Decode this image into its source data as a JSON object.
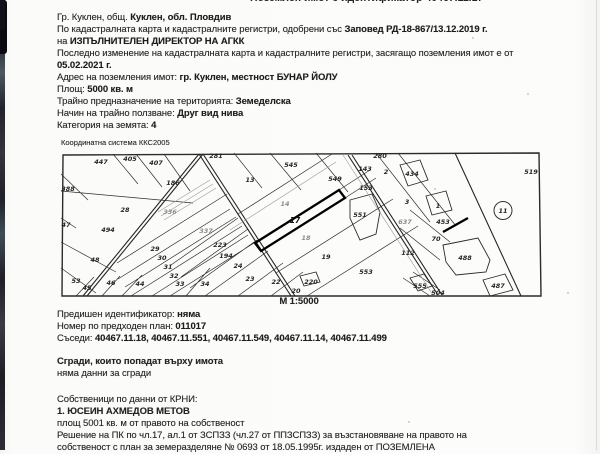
{
  "header": {
    "clipped_line": "Поземлен имот с идентификатор 40467.11.17"
  },
  "intro": {
    "lines": [
      {
        "pre": "Гр. Куклен, общ. ",
        "bold": "Куклен, обл. Пловдив"
      },
      {
        "pre": "По кадастралната карта и кадастралните регистри, одобрени със ",
        "bold": "Заповед РД-18-867/13.12.2019 г."
      },
      {
        "pre": "на ",
        "bold": "ИЗПЪЛНИТЕЛЕН ДИРЕКТОР НА АГКК"
      },
      {
        "pre": "Последно изменение на кадастралната карта и кадастралните регистри, засягащо поземления имот е от",
        "bold": ""
      },
      {
        "pre": "",
        "bold": "05.02.2021 г."
      },
      {
        "pre": "Адрес на поземления имот: ",
        "bold": "гр. Куклен, местност БУНАР ЙОЛУ"
      },
      {
        "pre": "Площ: ",
        "bold": "5000 кв. м"
      },
      {
        "pre": "Трайно предназначение на територията: ",
        "bold": "Земеделска"
      },
      {
        "pre": "Начин на трайно ползване: ",
        "bold": "Друг вид нива"
      },
      {
        "pre": "Категория на земята: ",
        "bold": "4"
      }
    ]
  },
  "map": {
    "coordinate_system": "Координатна система ККС2005",
    "scale": "М 1:5000",
    "subject_parcel": "17",
    "labels": [
      {
        "t": "447",
        "x": 43,
        "y": 14
      },
      {
        "t": "405",
        "x": 72,
        "y": 11
      },
      {
        "t": "407",
        "x": 98,
        "y": 15
      },
      {
        "t": "281",
        "x": 158,
        "y": 8
      },
      {
        "t": "545",
        "x": 233,
        "y": 17
      },
      {
        "t": "186",
        "x": 115,
        "y": 35
      },
      {
        "t": "13",
        "x": 192,
        "y": 32
      },
      {
        "t": "549",
        "x": 277,
        "y": 31
      },
      {
        "t": "280",
        "x": 322,
        "y": 8
      },
      {
        "t": "2",
        "x": 328,
        "y": 24
      },
      {
        "t": "434",
        "x": 354,
        "y": 26
      },
      {
        "t": "143",
        "x": 307,
        "y": 21
      },
      {
        "t": "153",
        "x": 308,
        "y": 40
      },
      {
        "t": "3",
        "x": 349,
        "y": 54
      },
      {
        "t": "1",
        "x": 380,
        "y": 58
      },
      {
        "t": "519",
        "x": 473,
        "y": 24
      },
      {
        "t": "11",
        "x": 445,
        "y": 63,
        "circled": true
      },
      {
        "t": "388",
        "x": 10,
        "y": 41
      },
      {
        "t": "28",
        "x": 67,
        "y": 62
      },
      {
        "t": "47",
        "x": 8,
        "y": 77
      },
      {
        "t": "494",
        "x": 50,
        "y": 82
      },
      {
        "t": "48",
        "x": 37,
        "y": 112
      },
      {
        "t": "53",
        "x": 18,
        "y": 133
      },
      {
        "t": "45",
        "x": 29,
        "y": 140
      },
      {
        "t": "46",
        "x": 53,
        "y": 135
      },
      {
        "t": "44",
        "x": 82,
        "y": 136
      },
      {
        "t": "29",
        "x": 97,
        "y": 101
      },
      {
        "t": "30",
        "x": 104,
        "y": 110
      },
      {
        "t": "31",
        "x": 110,
        "y": 119
      },
      {
        "t": "32",
        "x": 116,
        "y": 128
      },
      {
        "t": "33",
        "x": 122,
        "y": 136
      },
      {
        "t": "34",
        "x": 147,
        "y": 136
      },
      {
        "t": "337",
        "x": 148,
        "y": 83,
        "grey": true
      },
      {
        "t": "223",
        "x": 162,
        "y": 97
      },
      {
        "t": "194",
        "x": 168,
        "y": 108
      },
      {
        "t": "24",
        "x": 180,
        "y": 118
      },
      {
        "t": "23",
        "x": 192,
        "y": 131
      },
      {
        "t": "22",
        "x": 218,
        "y": 134
      },
      {
        "t": "20",
        "x": 238,
        "y": 143
      },
      {
        "t": "14",
        "x": 227,
        "y": 56,
        "grey": true
      },
      {
        "t": "17",
        "x": 237,
        "y": 73,
        "bold": true
      },
      {
        "t": "18",
        "x": 248,
        "y": 90,
        "grey": true
      },
      {
        "t": "19",
        "x": 268,
        "y": 109
      },
      {
        "t": "551",
        "x": 302,
        "y": 67
      },
      {
        "t": "336",
        "x": 112,
        "y": 64,
        "grey": true
      },
      {
        "t": "637",
        "x": 347,
        "y": 74,
        "grey": true
      },
      {
        "t": "453",
        "x": 385,
        "y": 74
      },
      {
        "t": "70",
        "x": 378,
        "y": 91
      },
      {
        "t": "112",
        "x": 350,
        "y": 105
      },
      {
        "t": "488",
        "x": 407,
        "y": 110
      },
      {
        "t": "553",
        "x": 308,
        "y": 124
      },
      {
        "t": "220",
        "x": 253,
        "y": 134
      },
      {
        "t": "555",
        "x": 362,
        "y": 138
      },
      {
        "t": "504",
        "x": 380,
        "y": 145
      },
      {
        "t": "487",
        "x": 440,
        "y": 138
      }
    ]
  },
  "details": {
    "previous_id": {
      "pre": "Предишен идентификатор: ",
      "bold": "няма"
    },
    "previous_plan": {
      "pre": "Номер по предходен план: ",
      "bold": "011017"
    },
    "neighbors": {
      "pre": "Съседи: ",
      "bold": "40467.11.18, 40467.11.551, 40467.11.549, 40467.11.14, 40467.11.499"
    }
  },
  "buildings": {
    "title": "Сгради, които попадат върху имота",
    "value": "няма данни за сгради"
  },
  "owners": {
    "title": "Собственици по данни от КРНИ:",
    "owner_name": "1. ЮСЕИН АХМЕДОВ МЕТОВ",
    "area_line": "площ 5001 кв. м от правото на собственост",
    "decision_line1": "Решение на ПК по чл.17, ал.1 от ЗСПЗЗ (чл.27 от ППЗСПЗЗ) за възстановяване на правото на",
    "decision_line2": "собственост с план за земеразделяне № 0693 от 18.05.1995г. издаден от ПОЗЕМЛЕНА"
  }
}
